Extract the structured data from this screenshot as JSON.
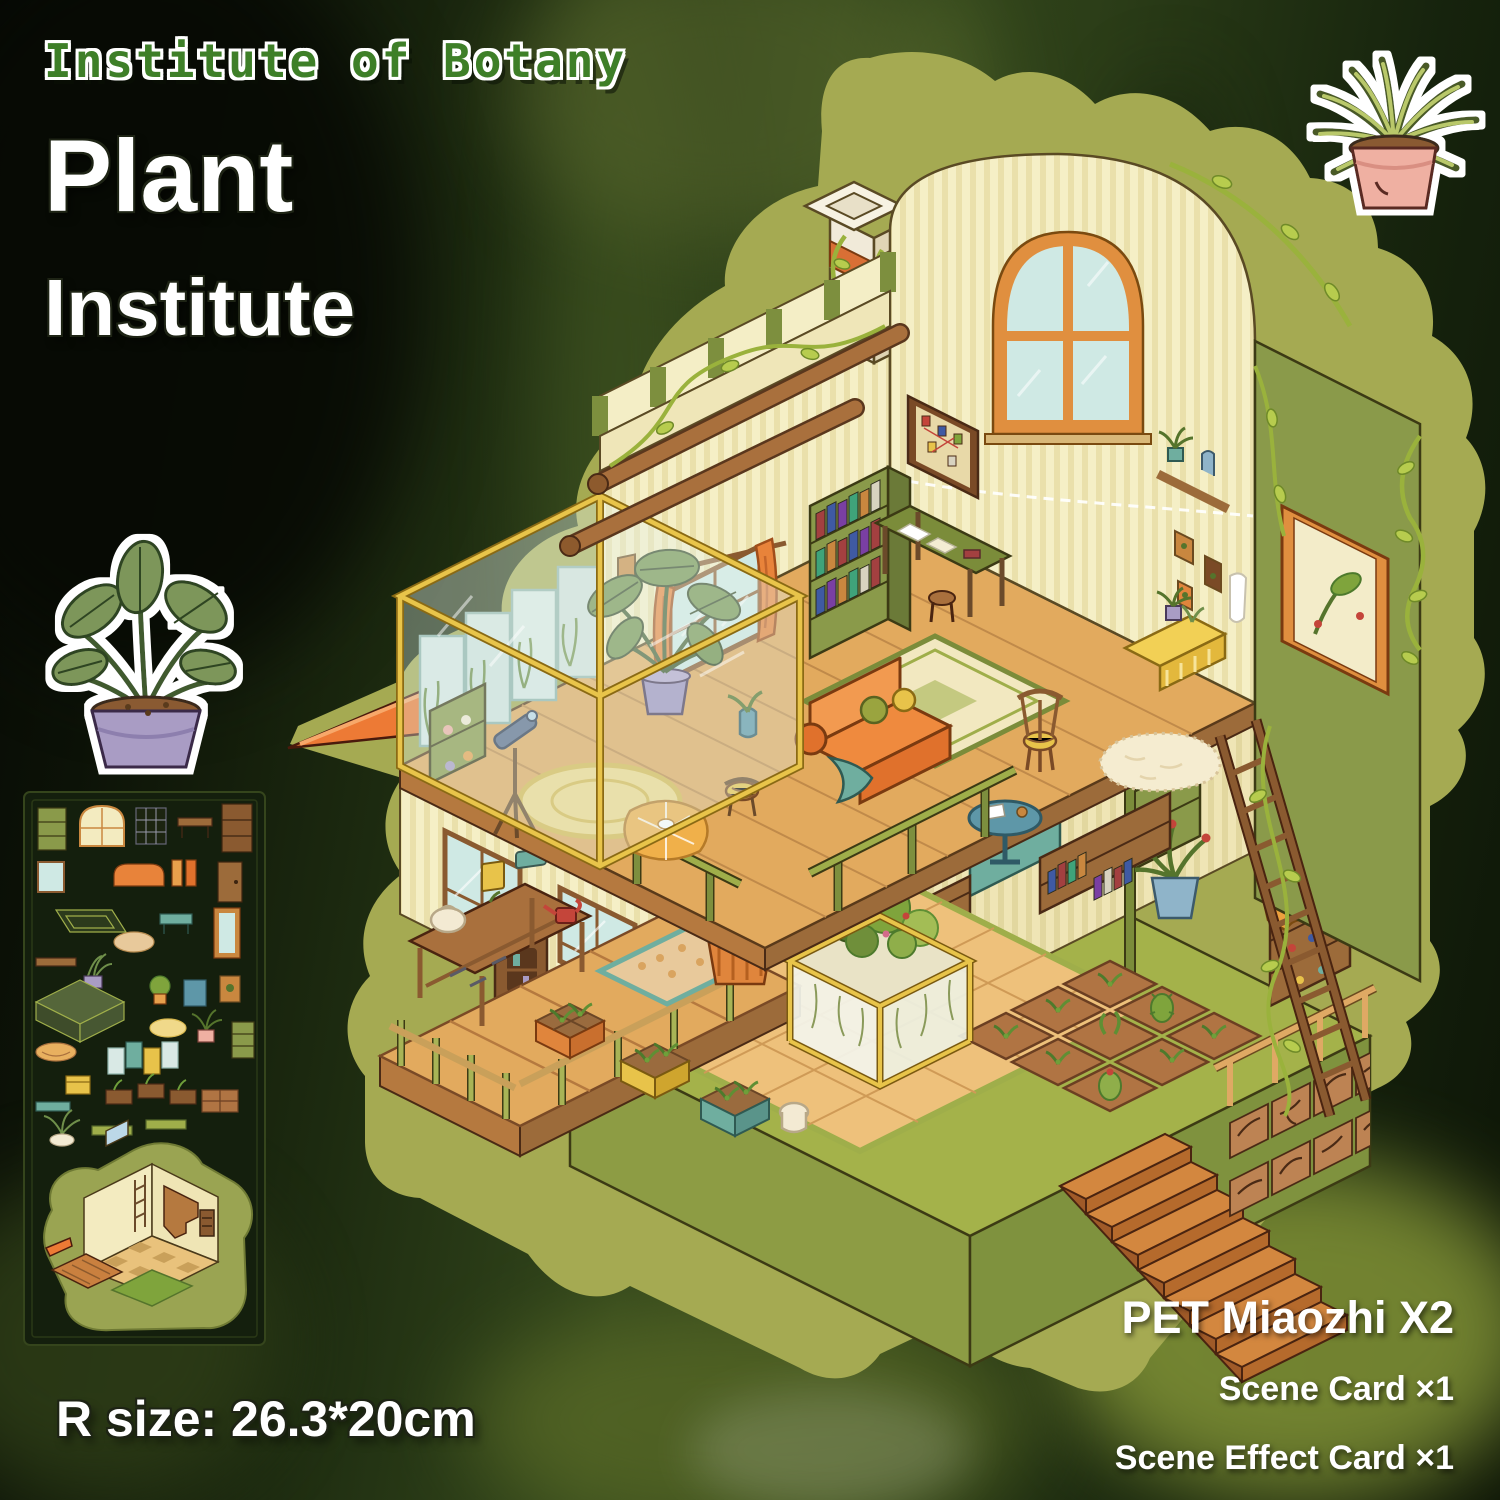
{
  "poster": {
    "brand_label": "Institute of Botany",
    "title_line1": "Plant",
    "title_line2": "Institute",
    "size_label": "R size: 26.3*20cm",
    "contents": [
      {
        "label": "PET Miaozhi X2"
      },
      {
        "label": "Scene Card ×1"
      },
      {
        "label": "Scene Effect Card ×1"
      }
    ]
  },
  "stickers": {
    "left_plant": "potted-monstera-sticker",
    "top_right_plant": "spider-plant-sticker",
    "sheet": "furniture-sticker-sheet",
    "scene": "plant-institute-isometric-scene"
  },
  "colors": {
    "title_green": "#3e7f28",
    "text_white": "#ffffff",
    "sticker_blob": "#a5aa52",
    "wall_cream": "#f5efc6",
    "wood_tan": "#e2aa5e",
    "accent_orange": "#e8833a",
    "leaf_green": "#7d8f3e",
    "base_green": "#a4b24a",
    "pot_purple": "#a99cc4",
    "pot_pink": "#efb0a2"
  }
}
